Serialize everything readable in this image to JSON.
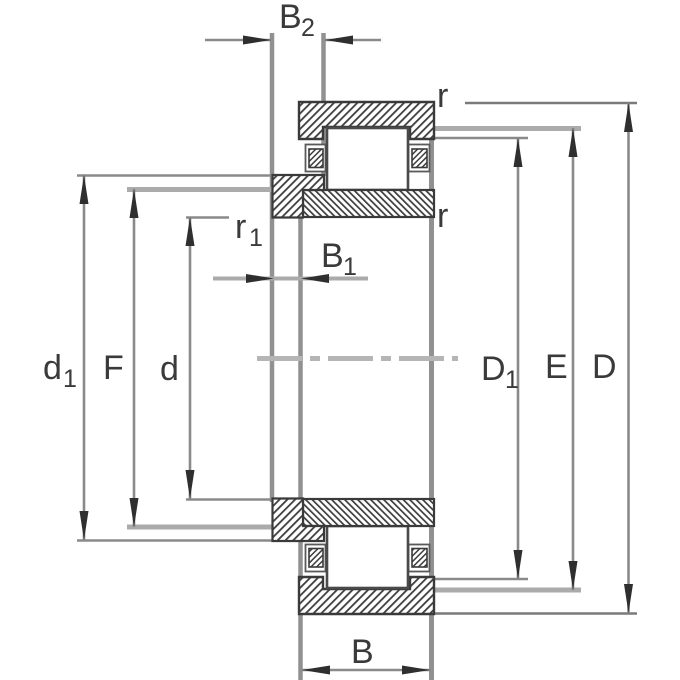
{
  "figure": {
    "type": "bearing-dimension-drawing",
    "background": "#ffffff",
    "colors": {
      "outline": "#3a3a3a",
      "dimension_line": "#8a8a8a",
      "light_leader": "#ababab",
      "centerline": "#b5b5b5",
      "arrow": "#2f2f2f",
      "text": "#3a3a3a"
    },
    "labels": {
      "B2": {
        "base": "B",
        "sub": "2"
      },
      "B1": {
        "base": "B",
        "sub": "1"
      },
      "B": "B",
      "r_top": "r",
      "r_mid": "r",
      "r1": {
        "base": "r",
        "sub": "1"
      },
      "d1": {
        "base": "d",
        "sub": "1"
      },
      "F": "F",
      "d": "d",
      "D1": {
        "base": "D",
        "sub": "1"
      },
      "E": "E",
      "D": "D"
    }
  }
}
